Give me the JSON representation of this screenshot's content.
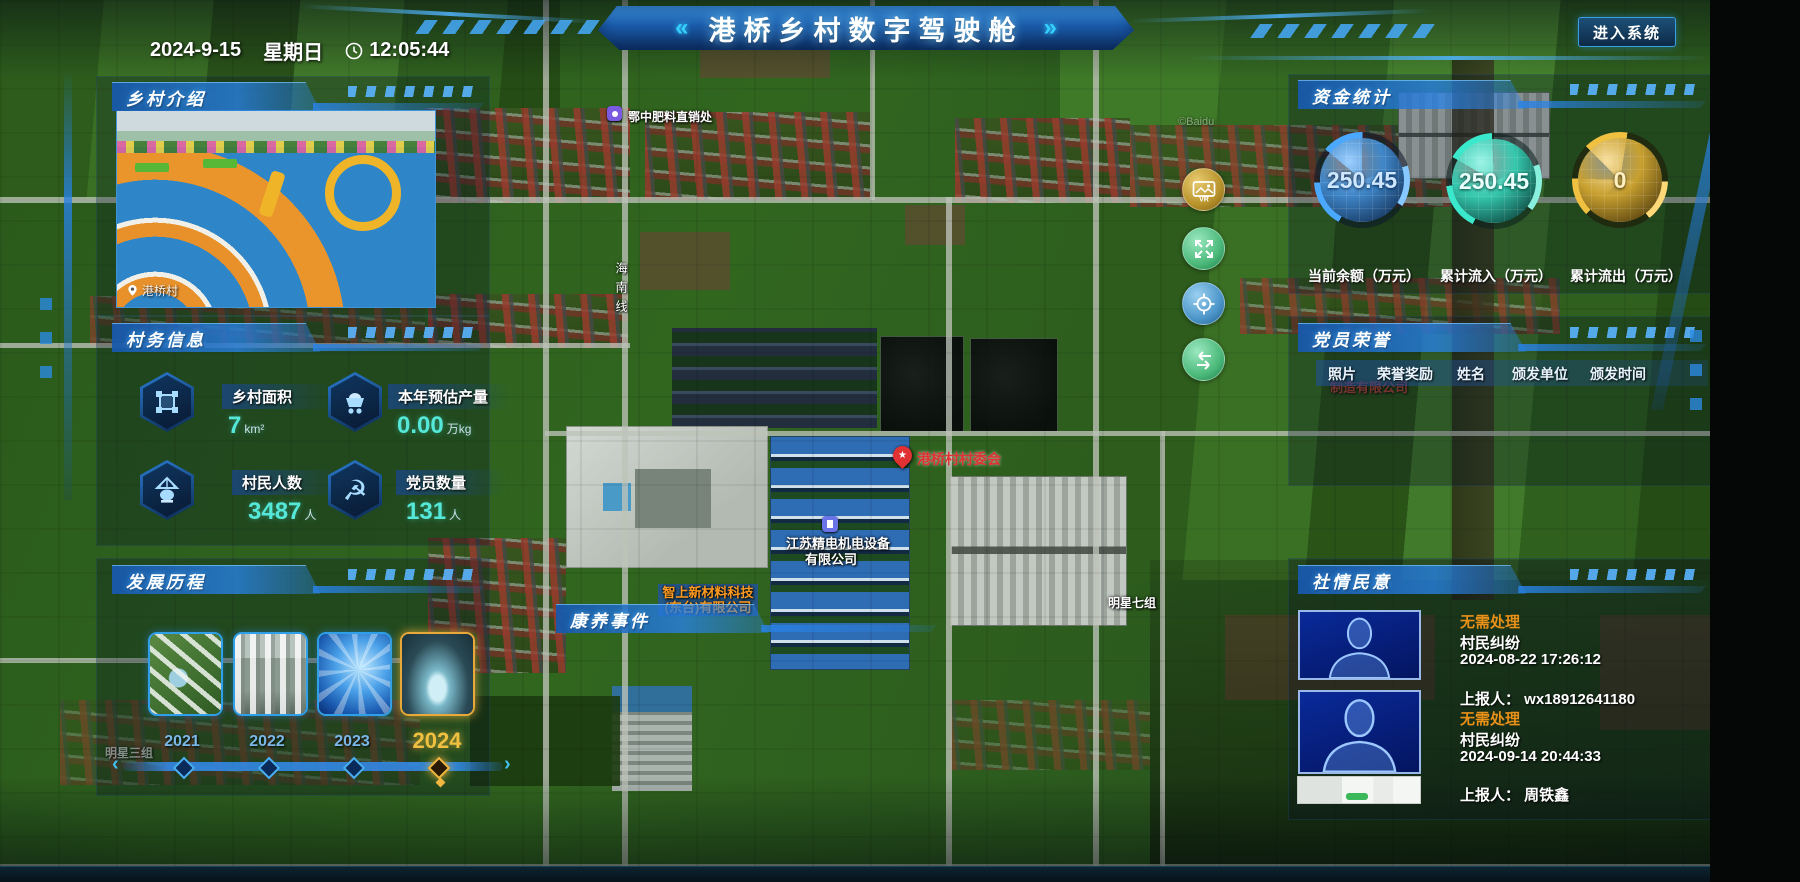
{
  "header": {
    "date": "2024-9-15",
    "weekday": "星期日",
    "time": "12:05:44",
    "title": "港桥乡村数字驾驶舱",
    "arrow_left": "«",
    "arrow_right": "»",
    "enter_button": "进入系统"
  },
  "village_intro": {
    "title": "乡村介绍",
    "photo_caption": "港桥村"
  },
  "village_info": {
    "title": "村务信息",
    "stats": [
      {
        "label": "乡村面积",
        "value": "7",
        "unit": "km²"
      },
      {
        "label": "本年预估产量",
        "value": "0.00",
        "unit": "万kg"
      },
      {
        "label": "村民人数",
        "value": "3487",
        "unit": "人"
      },
      {
        "label": "党员数量",
        "value": "131",
        "unit": "人"
      }
    ]
  },
  "development": {
    "title": "发展历程",
    "years": [
      "2021",
      "2022",
      "2023",
      "2024"
    ],
    "selected_year": "2024"
  },
  "funds": {
    "title": "资金统计",
    "gauges": [
      {
        "value": "250.45",
        "label": "当前余额（万元）",
        "color": "#4aa8ff"
      },
      {
        "value": "250.45",
        "label": "累计流入（万元）",
        "color": "#3ee6c9"
      },
      {
        "value": "0",
        "label": "累计流出（万元）",
        "color": "#f0c040"
      }
    ]
  },
  "party_honor": {
    "title": "党员荣誉",
    "columns": [
      "照片",
      "荣誉奖励",
      "姓名",
      "颁发单位",
      "颁发时间"
    ]
  },
  "sentiment": {
    "title": "社情民意",
    "items": [
      {
        "status": "无需处理",
        "type": "村民纠纷",
        "time": "2024-08-22 17:26:12",
        "reporter": "上报人： wx18912641180"
      },
      {
        "status": "无需处理",
        "type": "村民纠纷",
        "time": "2024-09-14 20:44:33",
        "reporter": "上报人： 周铁鑫"
      }
    ]
  },
  "health_events": {
    "title": "康养事件"
  },
  "map": {
    "labels": {
      "fertilizer_store": "鄂中肥料直销处",
      "road_vertical": "海南线",
      "village_committee": "港桥村村委会",
      "company1_line1": "江苏精电机电设备",
      "company1_line2": "有限公司",
      "company2_line1": "智上新材料科技",
      "company2_line2": "(东台)有限公司",
      "group7": "明星七组",
      "group3": "明星三组",
      "company_behind": "制造有限公司",
      "watermark": "©Baidu"
    },
    "controls": [
      {
        "name": "panorama",
        "label": "VR"
      },
      {
        "name": "fullscreen"
      },
      {
        "name": "locate"
      },
      {
        "name": "back"
      }
    ]
  },
  "colors": {
    "accent": "#35c8ff",
    "orange": "#e89018",
    "teal": "#52e8d2",
    "gold": "#f0c040"
  }
}
